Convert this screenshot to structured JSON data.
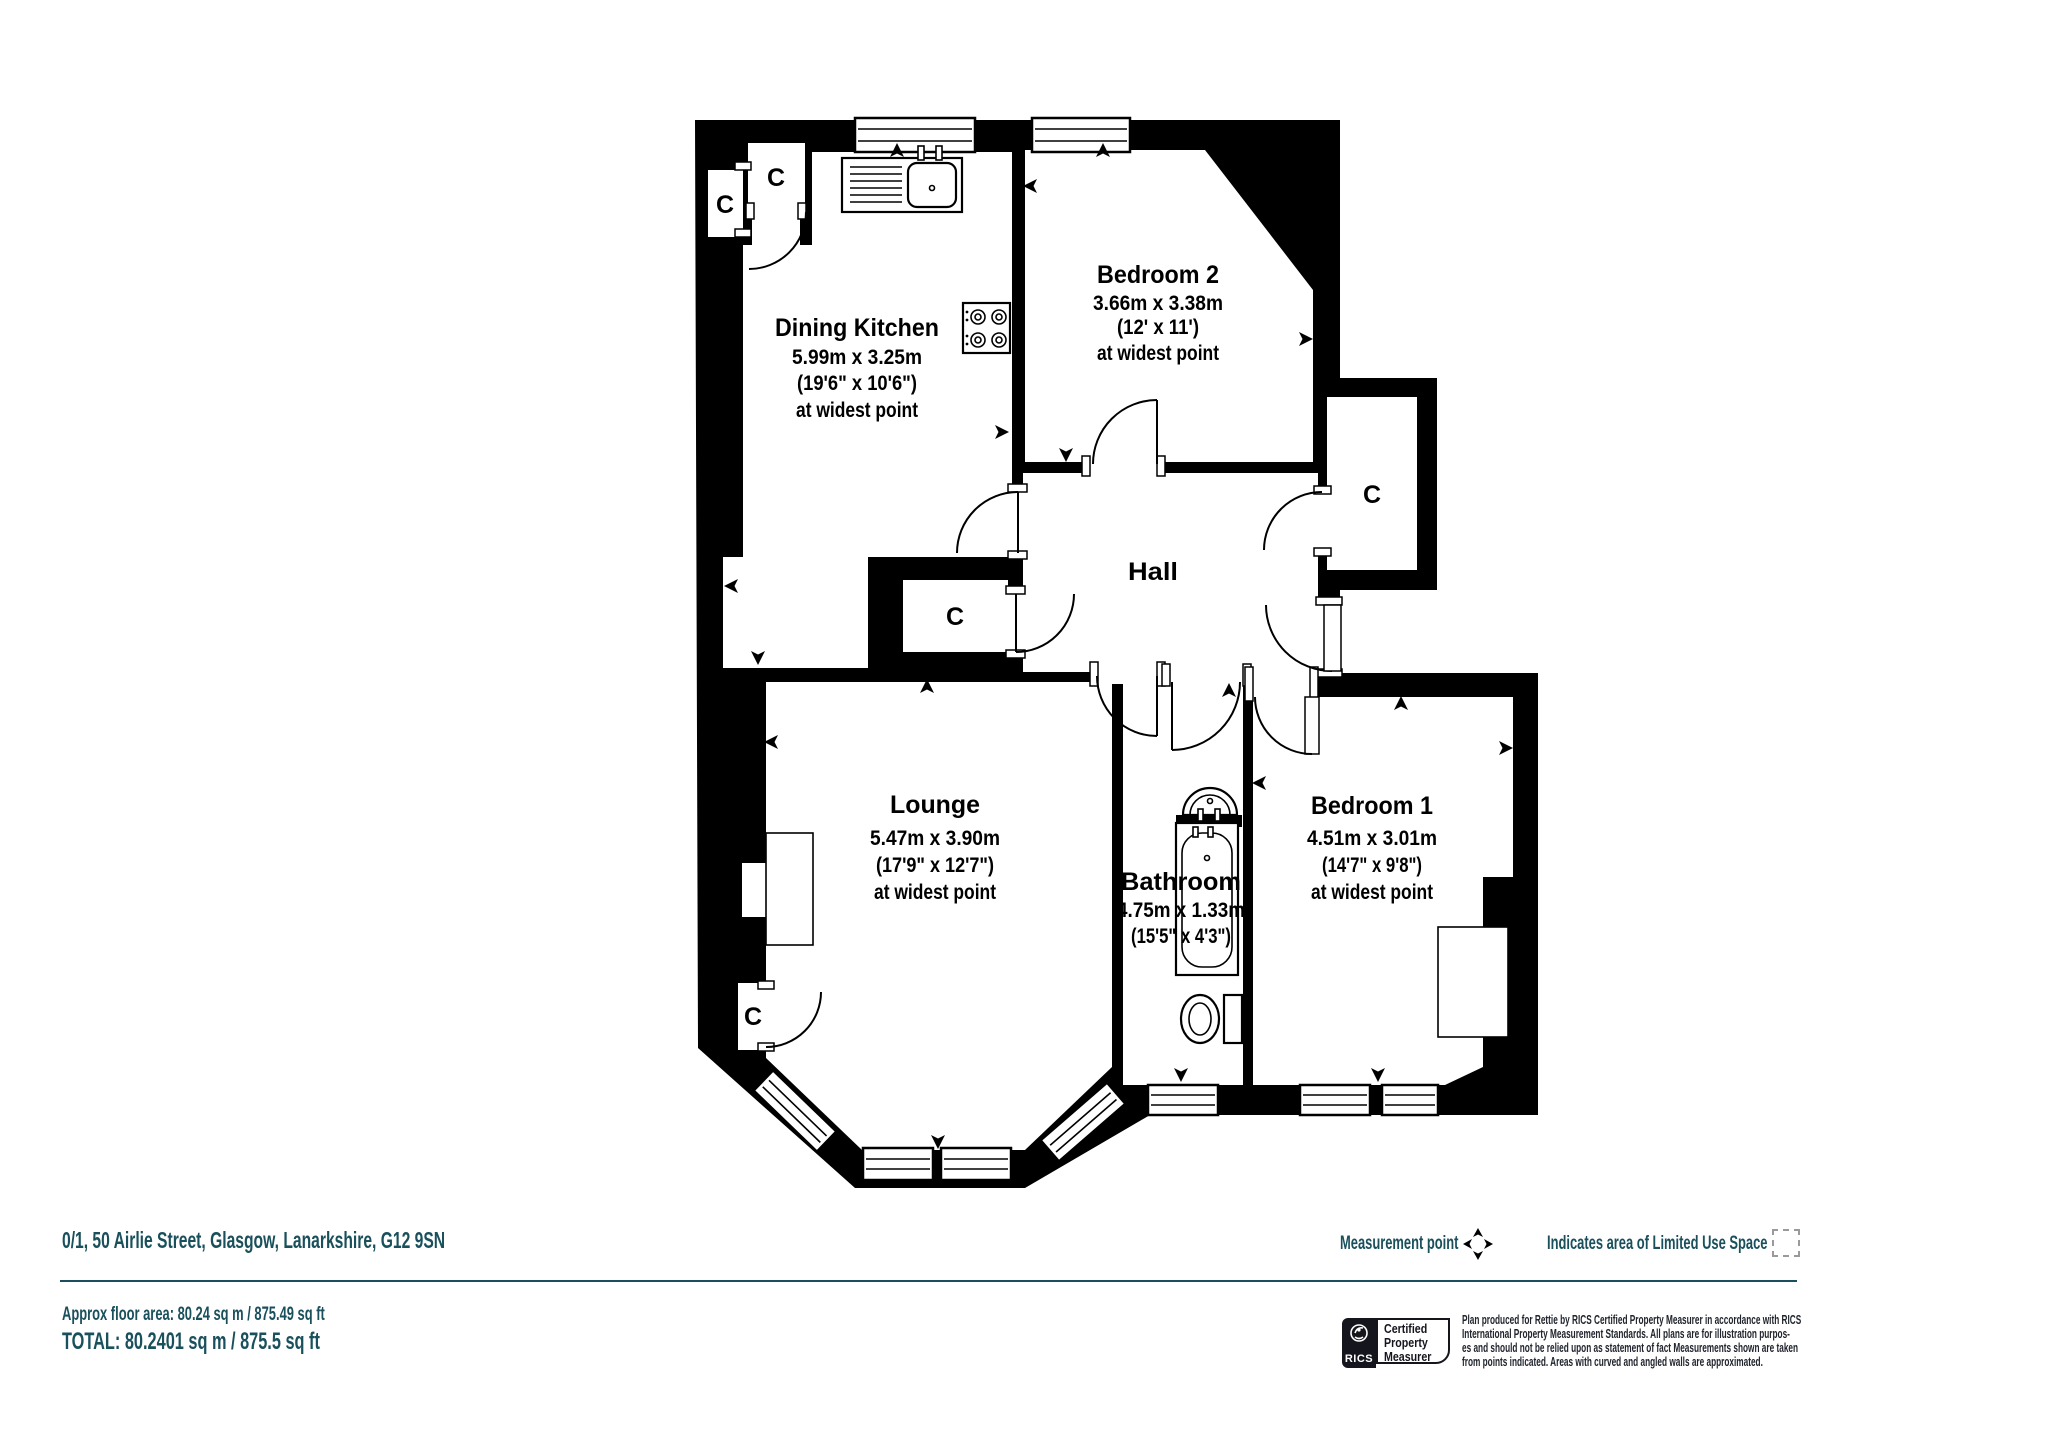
{
  "plan": {
    "closet_label": "C",
    "rooms": {
      "dining_kitchen": {
        "name": "Dining Kitchen",
        "metric": "5.99m x 3.25m",
        "imperial": "(19'6\" x 10'6\")",
        "note": "at widest point"
      },
      "bedroom_2": {
        "name": "Bedroom 2",
        "metric": "3.66m x 3.38m",
        "imperial": "(12' x 11')",
        "note": "at widest point"
      },
      "hall": {
        "name": "Hall"
      },
      "lounge": {
        "name": "Lounge",
        "metric": "5.47m x 3.90m",
        "imperial": "(17'9\" x 12'7\")",
        "note": "at widest point"
      },
      "bathroom": {
        "name": "Bathroom",
        "metric": "4.75m x 1.33m",
        "imperial": "(15'5\" x 4'3\")"
      },
      "bedroom_1": {
        "name": "Bedroom 1",
        "metric": "4.51m x 3.01m",
        "imperial": "(14'7\" x 9'8\")",
        "note": "at widest point"
      }
    }
  },
  "footer": {
    "address": "0/1, 50 Airlie Street, Glasgow, Lanarkshire, G12 9SN",
    "approx_area": "Approx floor area: 80.24 sq m / 875.49 sq ft",
    "total": "TOTAL: 80.2401 sq m / 875.5 sq ft",
    "legend": {
      "measurement_point": "Measurement point",
      "limited_use": "Indicates area of  Limited Use Space"
    },
    "rics": {
      "brand": "RICS",
      "cert_lines": [
        "Certified",
        "Property",
        "Measurer"
      ]
    },
    "disclaimer_lines": [
      "Plan produced for Rettie by RICS Certified Property Measurer in accordance with RICS",
      "International Property  Measurement Standards.  All plans are for illustration purpos-",
      "es and should not be relied upon as statement of fact Measurements shown are taken",
      "from points indicated. Areas with curved and angled walls are approximated."
    ]
  },
  "colors": {
    "teal": "#19505C",
    "ink": "#20242C",
    "plan_black": "#000000"
  }
}
